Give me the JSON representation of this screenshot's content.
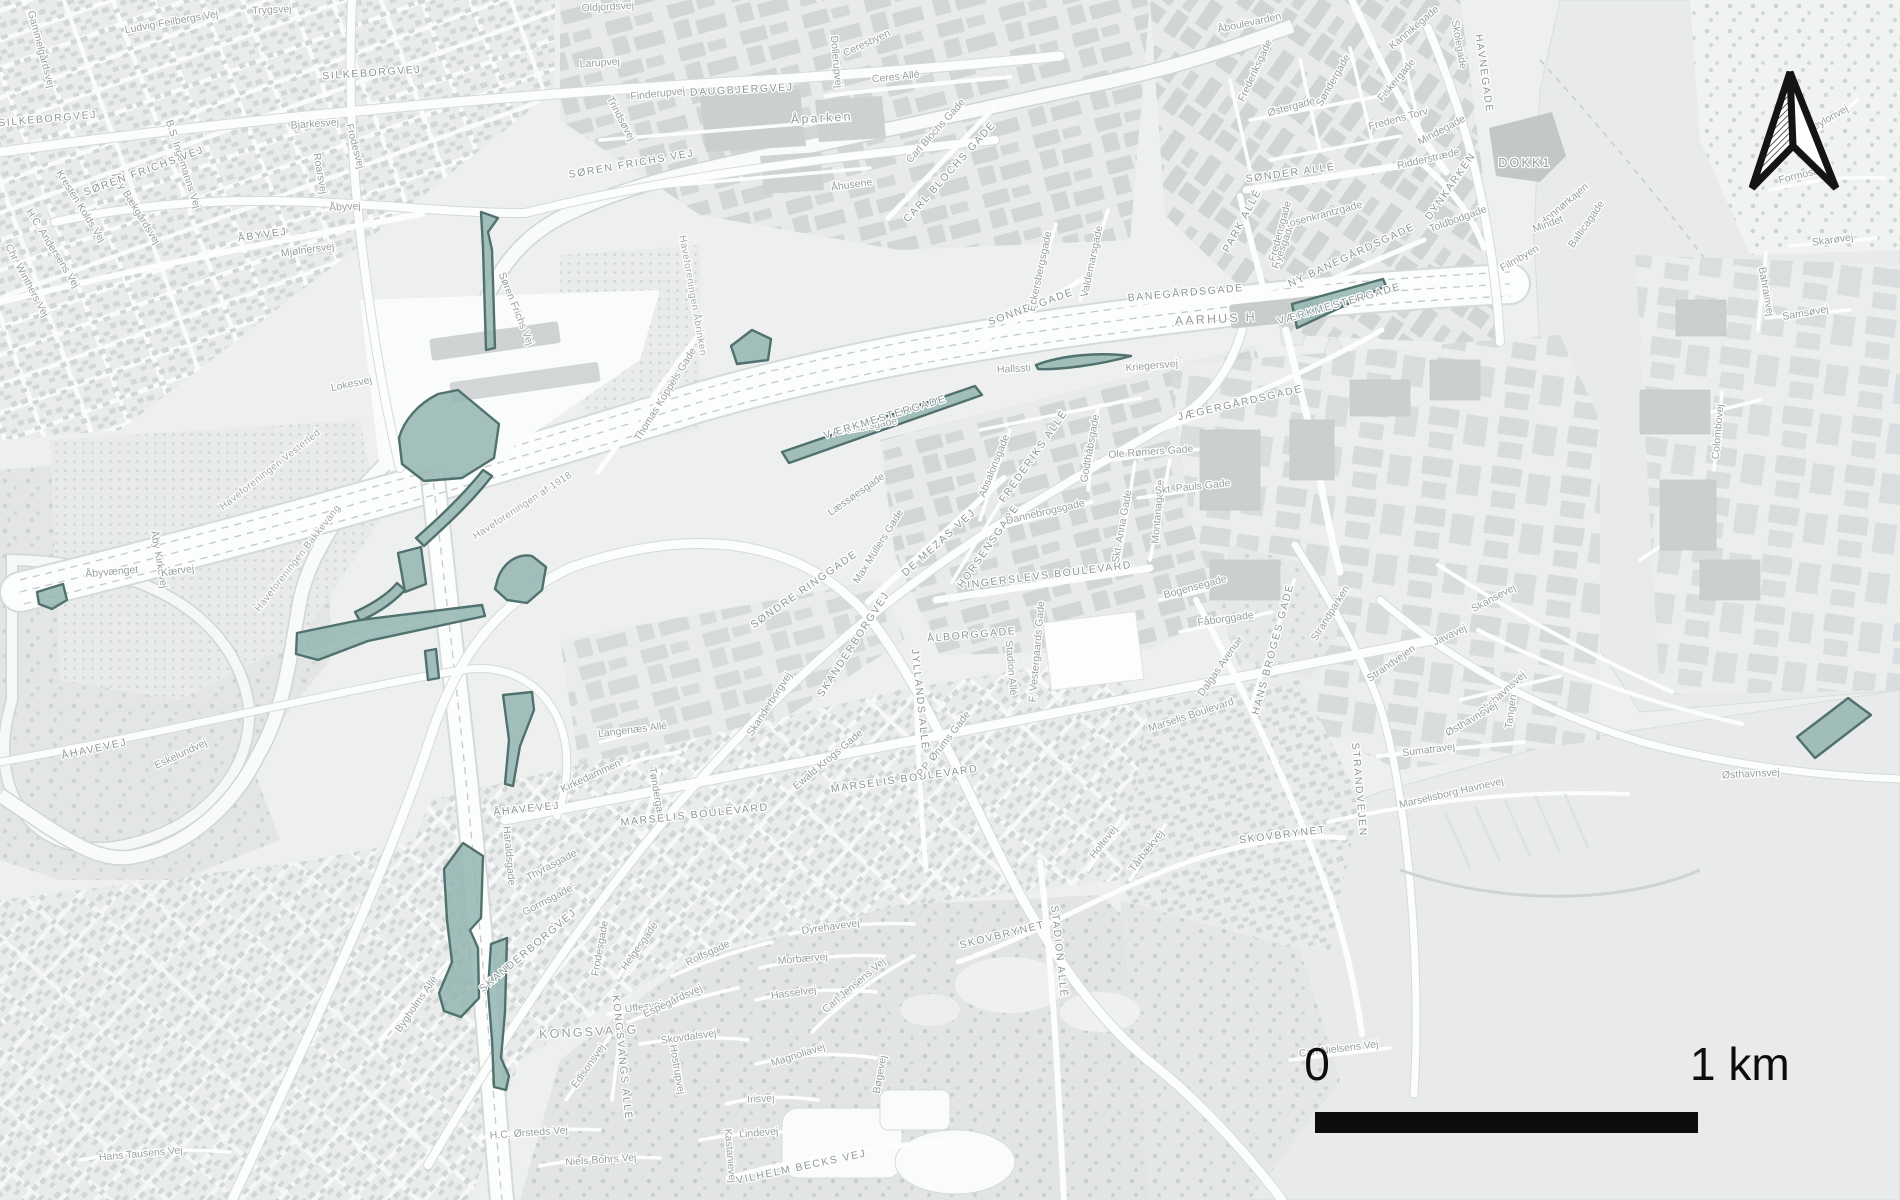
{
  "map": {
    "scale_bar": {
      "zero": "0",
      "one_km": "1 km"
    },
    "north_arrow": {
      "style": "split-chevron, left half hatched, right half white"
    },
    "colors": {
      "land": "#eef0f0",
      "water": "#e8eaeb",
      "park": "#e3e6e5",
      "buildings": "#d0d4d4",
      "roads": "#fcfdfd",
      "highlight_fill": "#93b5b1",
      "highlight_stroke": "#50716d",
      "label": "#9aa0a0",
      "scalebar": "#0d0d0d"
    },
    "highlights": [
      "M481,212 L498,218 L488,232 L492,250 L495,348 L486,350 L483,248 Z",
      "M399,438 C404,420 418,404 438,394 L458,390 L499,424 L494,458 L462,478 L424,481 L402,464 Z",
      "M492,476 C472,502 448,524 424,546 L416,538 C440,517 464,494 483,470 Z",
      "M398,553 L421,547 L426,584 L405,592 Z",
      "M405,590 C392,604 376,614 360,621 L355,612 C372,604 388,594 397,583 Z",
      "M297,633 L360,620 L482,605 L485,616 L368,641 L318,660 L296,654 Z",
      "M498,578 C504,562 518,553 532,556 L546,567 L542,590 L527,603 L507,600 L495,589 Z",
      "M37,592 L63,584 L67,600 L52,609 L39,604 Z",
      "M731,346 L752,330 L771,339 L768,360 L737,364 Z",
      "M782,452 L975,386 L982,395 L789,463 Z",
      "M1036,365 C1062,355 1100,352 1131,356 C1100,365 1058,370 1038,369 Z",
      "M1292,304 L1383,279 L1386,286 L1297,328 Z",
      "M1797,737 L1843,702 L1848,698 L1871,715 L1815,758 Z",
      "M444,869 L463,843 L483,856 L481,918 L470,930 L478,948 L479,998 L461,1017 L444,1011 L439,993 L452,962 L447,920 Z",
      "M491,944 L507,938 L505,1012 L501,1058 L509,1076 L506,1090 L494,1087 L492,1040 L488,990 Z",
      "M503,695 L532,692 L534,710 L520,746 L513,786 L505,784 L509,740 Z",
      "M425,651 L436,649 L439,678 L428,680 Z"
    ],
    "labels": [
      [
        "Gammelgårdsvej",
        38,
        50,
        75,
        0
      ],
      [
        "Ludvig Feilbergs Vej",
        172,
        25,
        -10,
        0
      ],
      [
        "Trygsvej",
        272,
        13,
        -3,
        0
      ],
      [
        "SILKEBORGVEJ",
        372,
        76,
        -4,
        1
      ],
      [
        "SILKEBORGVEJ",
        48,
        122,
        -5,
        1
      ],
      [
        "Kresten Kolds Vej",
        78,
        208,
        58,
        0
      ],
      [
        "H.C. Andersens Vej",
        50,
        250,
        58,
        0
      ],
      [
        "Chr. Winthers Vej",
        24,
        282,
        62,
        0
      ],
      [
        "Åby Bækgårdsvej",
        133,
        210,
        58,
        0
      ],
      [
        "B.S. Ingemanns Vej",
        180,
        165,
        72,
        0
      ],
      [
        "Bjarkesvej",
        315,
        127,
        -4,
        0
      ],
      [
        "Frodesvej",
        352,
        147,
        75,
        0
      ],
      [
        "Roarsvej",
        317,
        174,
        80,
        0
      ],
      [
        "Åbyvej",
        345,
        210,
        -3,
        0
      ],
      [
        "ÅBYVEJ",
        263,
        238,
        -8,
        1
      ],
      [
        "Mjølnersvej",
        308,
        253,
        -8,
        0
      ],
      [
        "SØREN FRICHS VEJ",
        145,
        174,
        -20,
        1
      ],
      [
        "SØREN FRICHS VEJ",
        632,
        167,
        -10,
        1
      ],
      [
        "Søren Frichs Vej",
        513,
        310,
        68,
        0
      ],
      [
        "Oldjordsvej",
        608,
        10,
        -3,
        0
      ],
      [
        "Larupvej",
        600,
        66,
        -4,
        0
      ],
      [
        "Finderupvej",
        658,
        97,
        -6,
        0
      ],
      [
        "Trindsøvej",
        618,
        120,
        62,
        0
      ],
      [
        "DAUGBJERGVEJ",
        742,
        93,
        -3,
        1
      ],
      [
        "Dollerupvej",
        833,
        62,
        85,
        0
      ],
      [
        "Ceresbyen",
        868,
        46,
        -25,
        0
      ],
      [
        "Ceres Allé",
        896,
        80,
        -6,
        0
      ],
      [
        "Åparken",
        822,
        122,
        -3,
        2
      ],
      [
        "Åhusene",
        852,
        188,
        -8,
        0
      ],
      [
        "Carl Blochs Gade",
        938,
        133,
        -48,
        0
      ],
      [
        "CARL BLOCHS GADE",
        952,
        174,
        -48,
        1
      ],
      [
        "Thomas Koppels Gade",
        668,
        396,
        -58,
        0
      ],
      [
        "Haveforeningen Åbrinken",
        690,
        296,
        80,
        3
      ],
      [
        "Haveforeningen af 1918",
        524,
        508,
        -33,
        3
      ],
      [
        "Åbyvænget",
        112,
        575,
        -5,
        0
      ],
      [
        "Åby Kirkevej",
        156,
        560,
        80,
        0
      ],
      [
        "Kærvej",
        178,
        574,
        -8,
        0
      ],
      [
        "Haveforeningen Vesterled",
        272,
        472,
        -38,
        3
      ],
      [
        "Haveforeningen Bakkevang",
        300,
        560,
        -52,
        3
      ],
      [
        "Lokesvej",
        352,
        387,
        -12,
        0
      ],
      [
        "Eskelundvej",
        182,
        757,
        -25,
        0
      ],
      [
        "ÅHAVEVEJ",
        95,
        752,
        -12,
        1
      ],
      [
        "ÅHAVEVEJ",
        527,
        812,
        -6,
        1
      ],
      [
        "Kirkedammen",
        592,
        779,
        -25,
        0
      ],
      [
        "Tøndergade",
        654,
        796,
        80,
        0
      ],
      [
        "Langenæs Allé",
        633,
        733,
        -7,
        0
      ],
      [
        "SKANDERBORGVEJ",
        856,
        646,
        -57,
        1
      ],
      [
        "Skanderborgvej",
        772,
        706,
        -57,
        0
      ],
      [
        "SØNDRE RINGGADE",
        806,
        592,
        -35,
        1
      ],
      [
        "MARSELIS BOULEVARD",
        695,
        818,
        -6,
        1
      ],
      [
        "MARSELIS BOULEVARD",
        905,
        782,
        -8,
        1
      ],
      [
        "Marselis Boulevard",
        1192,
        718,
        -18,
        0
      ],
      [
        "INGERSLEVS BOULEVARD",
        1050,
        578,
        -7,
        1
      ],
      [
        "ÅLBORGGADE",
        972,
        638,
        -5,
        1
      ],
      [
        "Stadion Allé",
        1008,
        668,
        85,
        0
      ],
      [
        "F. Vestergaards Gade",
        1040,
        652,
        -85,
        0
      ],
      [
        "JYLLANDS ALLÉ",
        917,
        700,
        84,
        1
      ],
      [
        "P.P. Ørums Gade",
        946,
        746,
        -52,
        0
      ],
      [
        "Ewald Krogs Gade",
        830,
        762,
        -40,
        0
      ],
      [
        "Læssøesgade",
        858,
        497,
        -35,
        0
      ],
      [
        "Max Müllers Gade",
        881,
        548,
        -58,
        0
      ],
      [
        "DE MEZAS VEJ",
        941,
        545,
        -42,
        1
      ],
      [
        "HORSENSGADE",
        991,
        548,
        -55,
        1
      ],
      [
        "Absalonsgade",
        997,
        467,
        -68,
        0
      ],
      [
        "FREDERIKS ALLÉ",
        1036,
        458,
        -55,
        1
      ],
      [
        "Dannebrogsgade",
        1046,
        515,
        -13,
        0
      ],
      [
        "Ole Rømers Gade",
        1151,
        455,
        -4,
        0
      ],
      [
        "Godthåbsgade",
        1093,
        449,
        -80,
        0
      ],
      [
        "Skt. Anna Gade",
        1125,
        527,
        -80,
        0
      ],
      [
        "Montanagade",
        1161,
        512,
        -85,
        0
      ],
      [
        "Skt. Pauls Gade",
        1193,
        490,
        -6,
        0
      ],
      [
        "Bogensegade",
        1196,
        590,
        -15,
        0
      ],
      [
        "Fåborggade",
        1226,
        622,
        -8,
        0
      ],
      [
        "Dalgas Avenue",
        1223,
        668,
        -55,
        0
      ],
      [
        "HANS BROGES GADE",
        1276,
        650,
        -75,
        1
      ],
      [
        "Strandparken",
        1333,
        615,
        -58,
        0
      ],
      [
        "Strandvejen",
        1393,
        666,
        -35,
        0
      ],
      [
        "STRANDVEJEN",
        1356,
        790,
        85,
        1
      ],
      [
        "Ankersgade",
        870,
        429,
        -10,
        0
      ],
      [
        "VÆRKMESTERGADE",
        886,
        420,
        -17,
        1
      ],
      [
        "VÆRKMESTERGADE",
        1340,
        307,
        -16,
        1
      ],
      [
        "Hallssti",
        1014,
        372,
        -3,
        0
      ],
      [
        "SONNESGADE",
        1032,
        310,
        -20,
        1
      ],
      [
        "Valdemarsgade",
        1095,
        262,
        -78,
        0
      ],
      [
        "Eckersbergsgade",
        1043,
        272,
        -78,
        0
      ],
      [
        "BANEGÅRDSGADE",
        1186,
        296,
        -5,
        1
      ],
      [
        "Kriegersvej",
        1152,
        369,
        -5,
        0
      ],
      [
        "AARHUS H",
        1216,
        323,
        -3,
        2
      ],
      [
        "JÆGERGÅRDSGADE",
        1241,
        406,
        -13,
        1
      ],
      [
        "Ryesgade",
        1286,
        247,
        -70,
        0
      ],
      [
        "PARK ALLÉ",
        1245,
        222,
        -62,
        1
      ],
      [
        "Rosenkrantzgade",
        1323,
        218,
        -15,
        0
      ],
      [
        "Fredensgade",
        1283,
        232,
        -75,
        0
      ],
      [
        "SØNDER ALLÉ",
        1291,
        176,
        -8,
        1
      ],
      [
        "Østergade",
        1292,
        110,
        -15,
        0
      ],
      [
        "Søndergade",
        1336,
        82,
        -60,
        0
      ],
      [
        "Frederiksgade",
        1258,
        72,
        -65,
        0
      ],
      [
        "Fiskergade",
        1399,
        82,
        -50,
        0
      ],
      [
        "Kannikegade",
        1416,
        30,
        -40,
        0
      ],
      [
        "Åboulevarden",
        1250,
        26,
        -12,
        0
      ],
      [
        "Fredens Torv",
        1399,
        122,
        -15,
        0
      ],
      [
        "Mindegade",
        1443,
        133,
        -28,
        0
      ],
      [
        "Ridderstræde",
        1429,
        162,
        -13,
        0
      ],
      [
        "Skolegade",
        1456,
        45,
        80,
        0
      ],
      [
        "HAVNEGADE",
        1481,
        74,
        82,
        1
      ],
      [
        "DYNKARKEN",
        1453,
        188,
        -55,
        1
      ],
      [
        "Toldbodgade",
        1459,
        222,
        -20,
        0
      ],
      [
        "NY BANEGÅRDSGADE",
        1353,
        258,
        -25,
        1
      ],
      [
        "DOKK1",
        1525,
        167,
        0,
        2
      ],
      [
        "Honnørkajen",
        1566,
        207,
        -40,
        0
      ],
      [
        "Mindet",
        1549,
        227,
        -20,
        0
      ],
      [
        "Balticagade",
        1589,
        226,
        -55,
        0
      ],
      [
        "Filmbyen",
        1521,
        261,
        -30,
        0
      ],
      [
        "Ceylonvej",
        1829,
        122,
        -30,
        0
      ],
      [
        "Formosavej",
        1806,
        177,
        -14,
        0
      ],
      [
        "Skarøvej",
        1833,
        243,
        -8,
        0
      ],
      [
        "Samsøvej",
        1806,
        316,
        -10,
        0
      ],
      [
        "Bahrainvej",
        1763,
        292,
        80,
        0
      ],
      [
        "Colombovej",
        1721,
        432,
        -85,
        0
      ],
      [
        "Skansevej",
        1495,
        601,
        -28,
        0
      ],
      [
        "Javavej",
        1451,
        638,
        -25,
        0
      ],
      [
        "Oliehavnsvej",
        1504,
        696,
        -42,
        0
      ],
      [
        "Tangen",
        1514,
        712,
        -82,
        0
      ],
      [
        "Østhavnsvej",
        1473,
        722,
        -30,
        0
      ],
      [
        "Østhavnsvej",
        1751,
        777,
        -3,
        0
      ],
      [
        "Sumatravej",
        1429,
        753,
        -7,
        0
      ],
      [
        "Marselisborg Havnevej",
        1452,
        796,
        -13,
        0
      ],
      [
        "Haraldsgade",
        506,
        856,
        85,
        0
      ],
      [
        "Thyrasgade",
        553,
        868,
        -28,
        0
      ],
      [
        "Gormsgade",
        549,
        903,
        -28,
        0
      ],
      [
        "SKANDERBORGVEJ",
        530,
        953,
        -40,
        1
      ],
      [
        "KONGSVANG",
        589,
        1036,
        -3,
        2
      ],
      [
        "Uffesvej",
        644,
        1010,
        -8,
        0
      ],
      [
        "Frodesgade",
        603,
        949,
        -80,
        0
      ],
      [
        "Helgesgade",
        642,
        948,
        -55,
        0
      ],
      [
        "Espegårdsvej",
        674,
        1004,
        -25,
        0
      ],
      [
        "Skovdalsvej",
        689,
        1040,
        -8,
        0
      ],
      [
        "Hostrupvej",
        674,
        1070,
        80,
        0
      ],
      [
        "Rolfsgade",
        709,
        956,
        -25,
        0
      ],
      [
        "Morbærvej",
        803,
        962,
        -5,
        0
      ],
      [
        "Hasselvej",
        794,
        996,
        -8,
        0
      ],
      [
        "Carl Jensens Vej",
        856,
        988,
        -40,
        0
      ],
      [
        "Dyrehavevej",
        831,
        930,
        -8,
        0
      ],
      [
        "Magnoliavej",
        799,
        1058,
        -18,
        0
      ],
      [
        "Irisvej",
        761,
        1102,
        -3,
        0
      ],
      [
        "Lindevej",
        759,
        1136,
        -5,
        0
      ],
      [
        "Bøgevej",
        883,
        1075,
        -80,
        0
      ],
      [
        "Kastanievej",
        727,
        1156,
        85,
        0
      ],
      [
        "VILHELM BECKS VEJ",
        802,
        1170,
        -12,
        1
      ],
      [
        "Niels Bohrs Vej",
        601,
        1163,
        -4,
        0
      ],
      [
        "H.C. Ørsteds Vej",
        529,
        1136,
        -4,
        0
      ],
      [
        "Hans Tausens Vej",
        141,
        1157,
        -5,
        0
      ],
      [
        "Bygholms Allé",
        419,
        1006,
        -55,
        0
      ],
      [
        "Edisonsvej",
        591,
        1068,
        -55,
        0
      ],
      [
        "KONGSVANGS ALLÉ",
        619,
        1058,
        84,
        1
      ],
      [
        "SKOVBRYNET",
        1003,
        938,
        -14,
        1
      ],
      [
        "SKOVBRYNET",
        1283,
        838,
        -7,
        1
      ],
      [
        "Holtevej",
        1106,
        844,
        -52,
        0
      ],
      [
        "Tårbækvej",
        1149,
        853,
        -52,
        0
      ],
      [
        "Carl Nielsens Vej",
        1339,
        1052,
        -7,
        0
      ],
      [
        "STADION ALLÉ",
        1056,
        952,
        84,
        1
      ]
    ]
  }
}
